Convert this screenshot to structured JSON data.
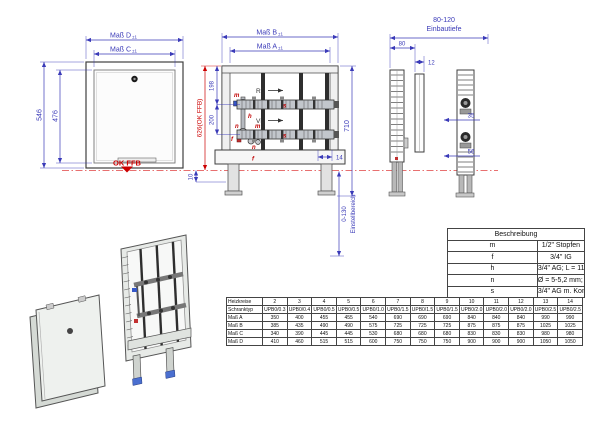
{
  "drawing": {
    "front_view": {
      "dim_d": "Maß D",
      "dim_c": "Maß C",
      "tol": "±1",
      "outer_height": "546",
      "inner_height": "476",
      "floor_label": "OK FFB"
    },
    "manifold_view": {
      "dim_b": "Maß B",
      "dim_a": "Maß A",
      "tol": "±1",
      "return_label": "RL",
      "flow_label": "VL",
      "total_height": "710",
      "top_to_return": "198",
      "return_to_flow": "200",
      "floor_to_top": "626(OK FFB)",
      "shelf_offset": "14",
      "base_offset": "10",
      "adjust_range": "0-130",
      "adjust_label": "Einstellbereich",
      "part_m": "m",
      "part_f": "f",
      "part_h": "h",
      "part_n": "n",
      "part_s": "s"
    },
    "side_view": {
      "depth_range": "80-120",
      "depth_label": "Einbautiefe",
      "rail_depth": "80",
      "door_depth": "12",
      "dim_35": "35",
      "dim_56": "56"
    }
  },
  "legend": {
    "title": "Beschreibung",
    "rows": [
      [
        "m",
        "1/2\" Stopfen"
      ],
      [
        "f",
        "3/4\" IG"
      ],
      [
        "h",
        "3/4\" AG; L = 110 mm"
      ],
      [
        "n",
        "Ø = 5-5,2 mm; M10 x 1"
      ],
      [
        "s",
        "3/4\" AG m. Konus"
      ]
    ]
  },
  "size_table": {
    "rows": [
      [
        "Heizkreise",
        "2",
        "3",
        "4",
        "5",
        "6",
        "7",
        "8",
        "9",
        "10",
        "11",
        "12",
        "13",
        "14"
      ],
      [
        "Schranktyp",
        "UPB0/0.3",
        "UPB0/0.4",
        "UPB0/0.5",
        "UPB0/0.5",
        "UPB0/1.0",
        "UPB0/1.5",
        "UPB0/1.5",
        "UPB0/1.5",
        "UPB0/2.0",
        "UPB0/2.0",
        "UPB0/2.0",
        "UPB0/2.5",
        "UPB0/2.5"
      ],
      [
        "Maß A",
        "350",
        "400",
        "455",
        "455",
        "540",
        "690",
        "690",
        "690",
        "840",
        "840",
        "840",
        "990",
        "990"
      ],
      [
        "Maß B",
        "385",
        "435",
        "490",
        "490",
        "575",
        "725",
        "725",
        "725",
        "875",
        "875",
        "875",
        "1025",
        "1025"
      ],
      [
        "Maß C",
        "340",
        "390",
        "445",
        "445",
        "530",
        "680",
        "680",
        "680",
        "830",
        "830",
        "830",
        "980",
        "980"
      ],
      [
        "Maß D",
        "410",
        "460",
        "515",
        "515",
        "600",
        "750",
        "750",
        "750",
        "900",
        "900",
        "900",
        "1050",
        "1050"
      ]
    ]
  },
  "colors": {
    "dimension": "#3a3ab8",
    "accent_red": "#cc0000"
  }
}
